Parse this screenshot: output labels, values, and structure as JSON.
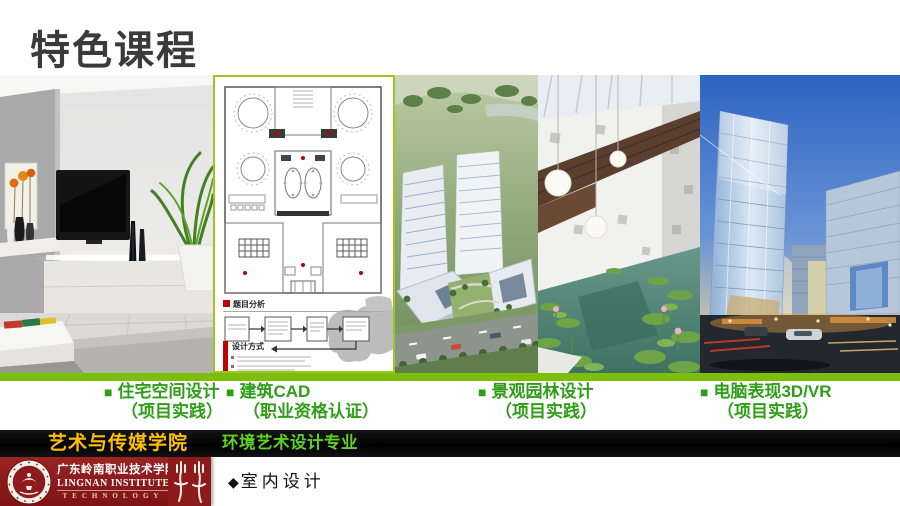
{
  "slide_title": "特色课程",
  "courses": [
    {
      "bullet": "■",
      "name": "住宅空间设计",
      "note": "（项目实践）"
    },
    {
      "bullet": "■",
      "name": "建筑CAD",
      "note": "（职业资格认证）"
    },
    {
      "bullet": "■",
      "name": "景观园林设计",
      "note": "（项目实践）"
    },
    {
      "bullet": "■",
      "name": "电脑表现3D/VR",
      "note": "（项目实践）"
    }
  ],
  "cad_panel": {
    "analysis_title": "题目分析",
    "method_title": "设计方式"
  },
  "banner": {
    "college": "艺术与传媒学院",
    "major": "环境艺术设计专业"
  },
  "footer": {
    "school_name_cn": "广东岭南职业技术学院",
    "school_name_en_line1": "LINGNAN INSTITUTE OF",
    "school_name_en_line2": "TECHNOLOGY",
    "section_marker": "◆",
    "section_label": "室内设计"
  },
  "images": [
    {
      "name": "residential-interior-render"
    },
    {
      "name": "architectural-cad-floor-plan"
    },
    {
      "name": "landscape-garden-aerial-render"
    },
    {
      "name": "atrium-lotus-pond-interior"
    },
    {
      "name": "computer-3d-vr-building-render"
    }
  ],
  "colors": {
    "divider_green": "#7CBE0A",
    "cad_border_green": "#9FC521",
    "course_text_green": "#2E9E17",
    "banner_yellow": "#FFC000",
    "banner_green": "#5ED321",
    "footer_red": "#8E1B1B",
    "title_gray": "#3A3A3A"
  }
}
